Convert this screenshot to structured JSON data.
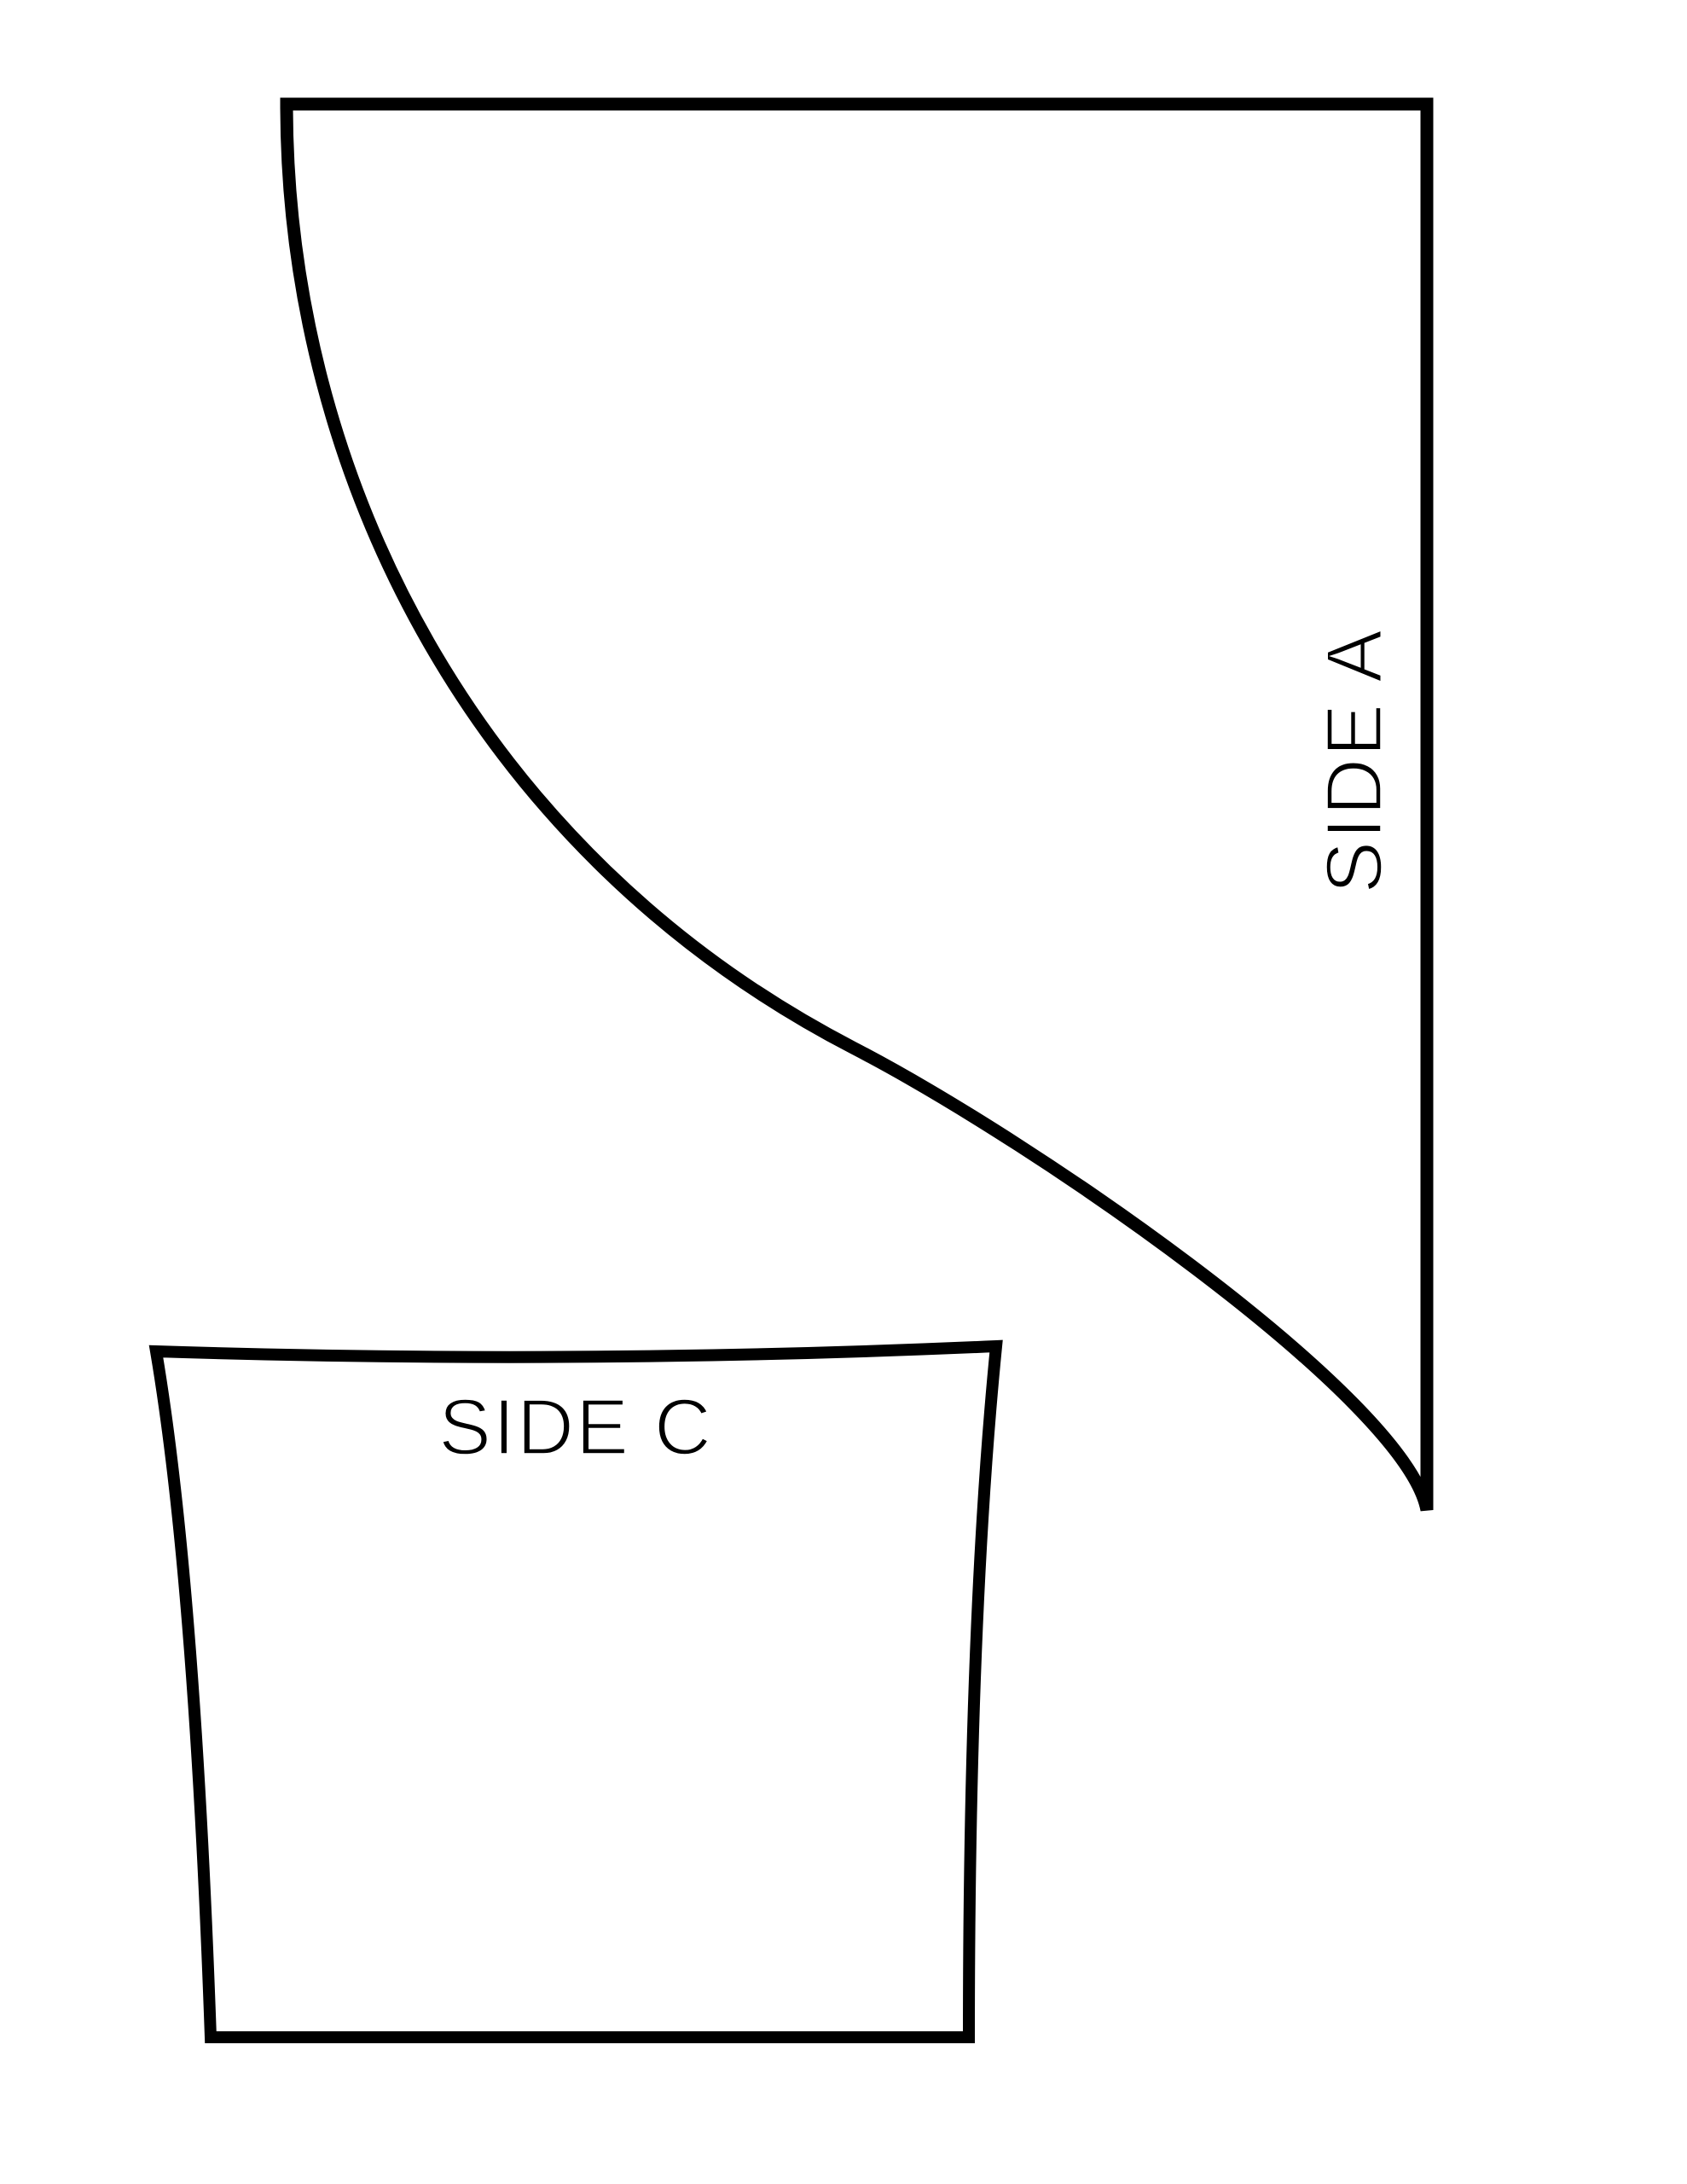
{
  "colors": {
    "ink": "#000000",
    "paper": "#ffffff"
  },
  "pieces": [
    {
      "id": "side-a",
      "label": "SIDE A"
    },
    {
      "id": "side-c",
      "label": "SIDE C"
    }
  ]
}
